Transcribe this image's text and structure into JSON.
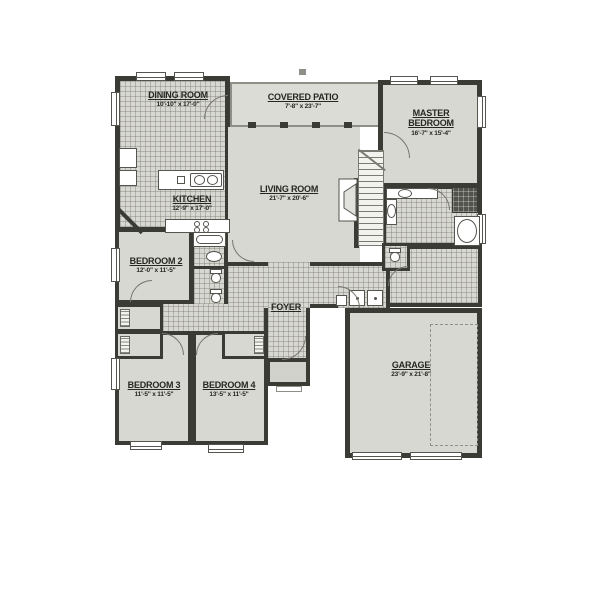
{
  "colors": {
    "wall": "#3b3b36",
    "room_fill": "#d8d8d2",
    "patio_outline": "#8f8f88",
    "text": "#262622",
    "fixture_outline": "#55554f",
    "background": "#ffffff"
  },
  "rooms": {
    "dining": {
      "name": "DINING ROOM",
      "dims": "10'-10\" x 17'-0\""
    },
    "patio": {
      "name": "COVERED PATIO",
      "dims": "7'-8\" x 23'-7\""
    },
    "master": {
      "name": "MASTER BEDROOM",
      "dims": "16'-7\" x 15'-4\""
    },
    "kitchen": {
      "name": "KITCHEN",
      "dims": "12'-9\" x 17'-0\""
    },
    "living": {
      "name": "LIVING ROOM",
      "dims": "21'-7\" x 20'-6\""
    },
    "bed2": {
      "name": "BEDROOM 2",
      "dims": "12'-0\" x 11'-5\""
    },
    "foyer": {
      "name": "FOYER",
      "dims": ""
    },
    "bed3": {
      "name": "BEDROOM 3",
      "dims": "11'-5\" x 11'-5\""
    },
    "bed4": {
      "name": "BEDROOM 4",
      "dims": "13'-5\" x 11'-5\""
    },
    "garage": {
      "name": "GARAGE",
      "dims": "23'-9\" x 21'-8\""
    }
  }
}
